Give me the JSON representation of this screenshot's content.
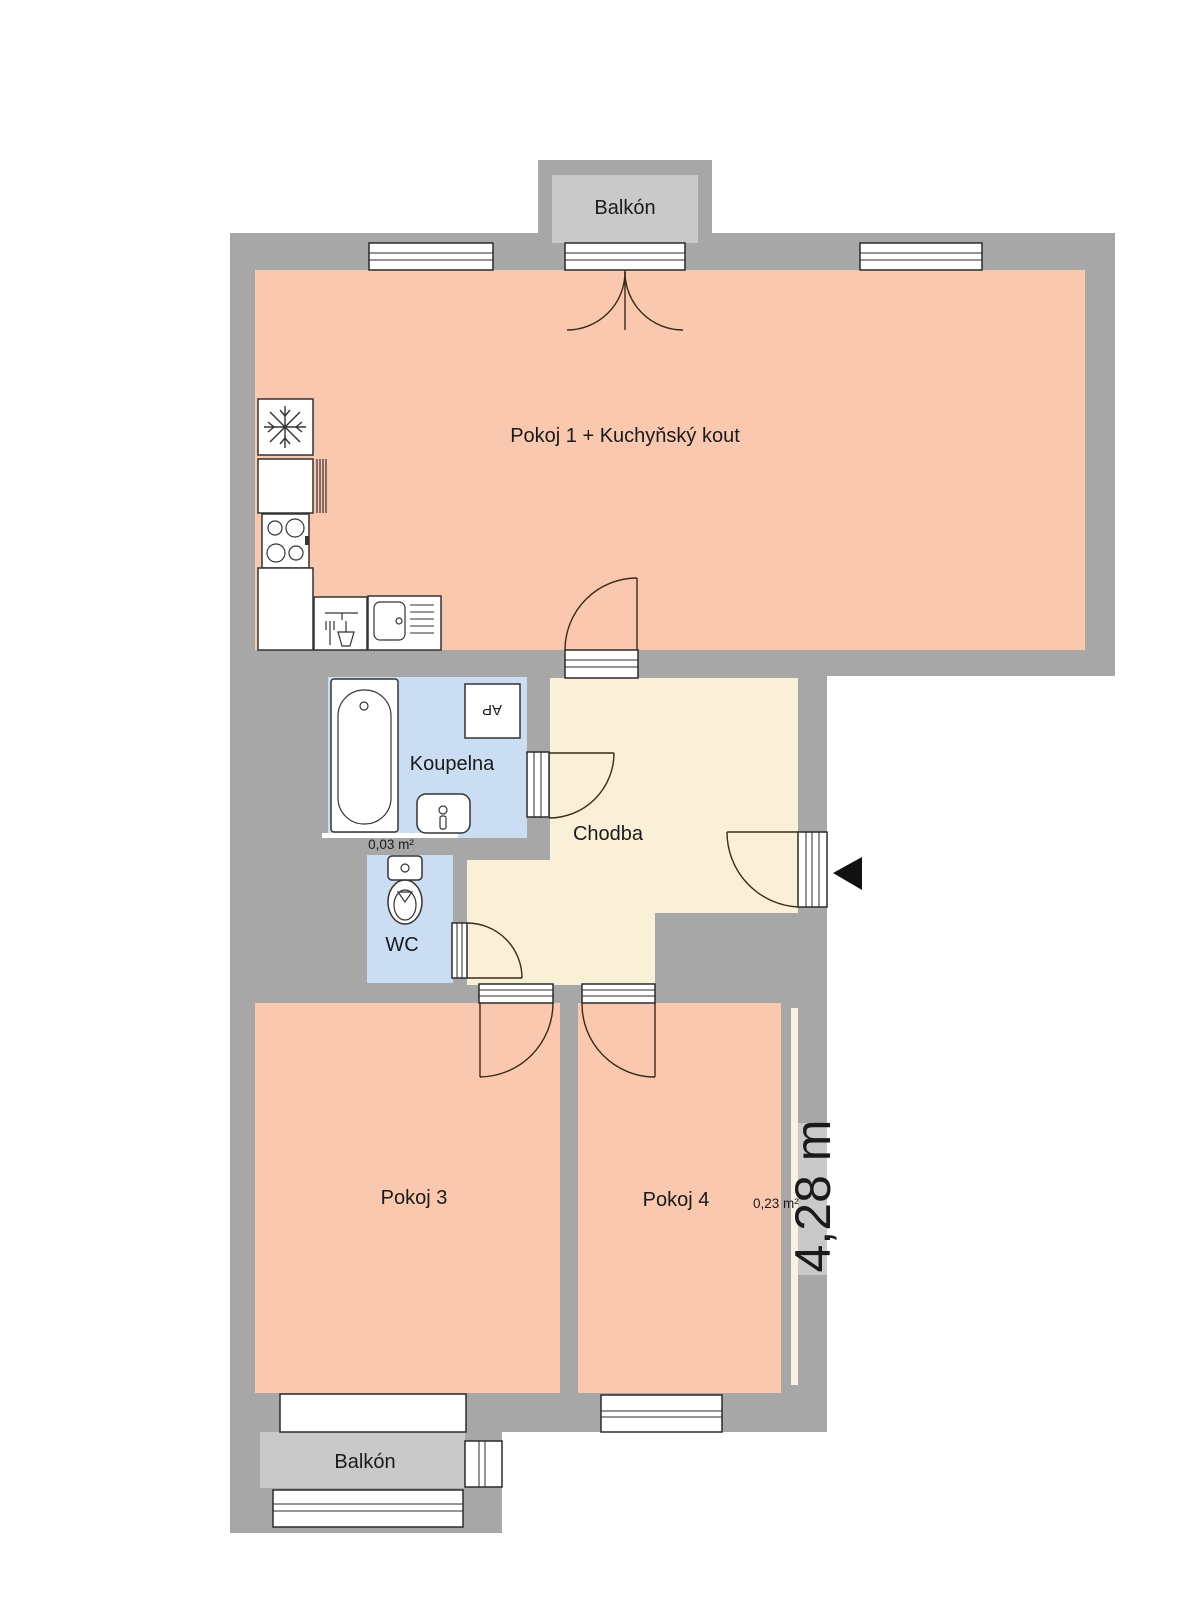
{
  "colors": {
    "wall": "#a7a7a7",
    "balcony_fill": "#c9c9c9",
    "room_fill": "#f9c8ae",
    "hall_fill": "#faf0d8",
    "bath_fill": "#cbddf3",
    "window_strip": "#f7f2e4",
    "entrance_marker": "#111111"
  },
  "labels": {
    "balcony_top": "Balkón",
    "room1": "Pokoj 1 + Kuchyňský kout",
    "bathroom": "Koupelna",
    "hall": "Chodba",
    "wc": "WC",
    "room3": "Pokoj 3",
    "room4": "Pokoj 4",
    "balcony_bottom": "Balkón",
    "washer": "AP"
  },
  "annotations": {
    "bath_area": "0,03 m²",
    "ledge_area": "0,23 m²",
    "dimension": "4,28 m"
  }
}
